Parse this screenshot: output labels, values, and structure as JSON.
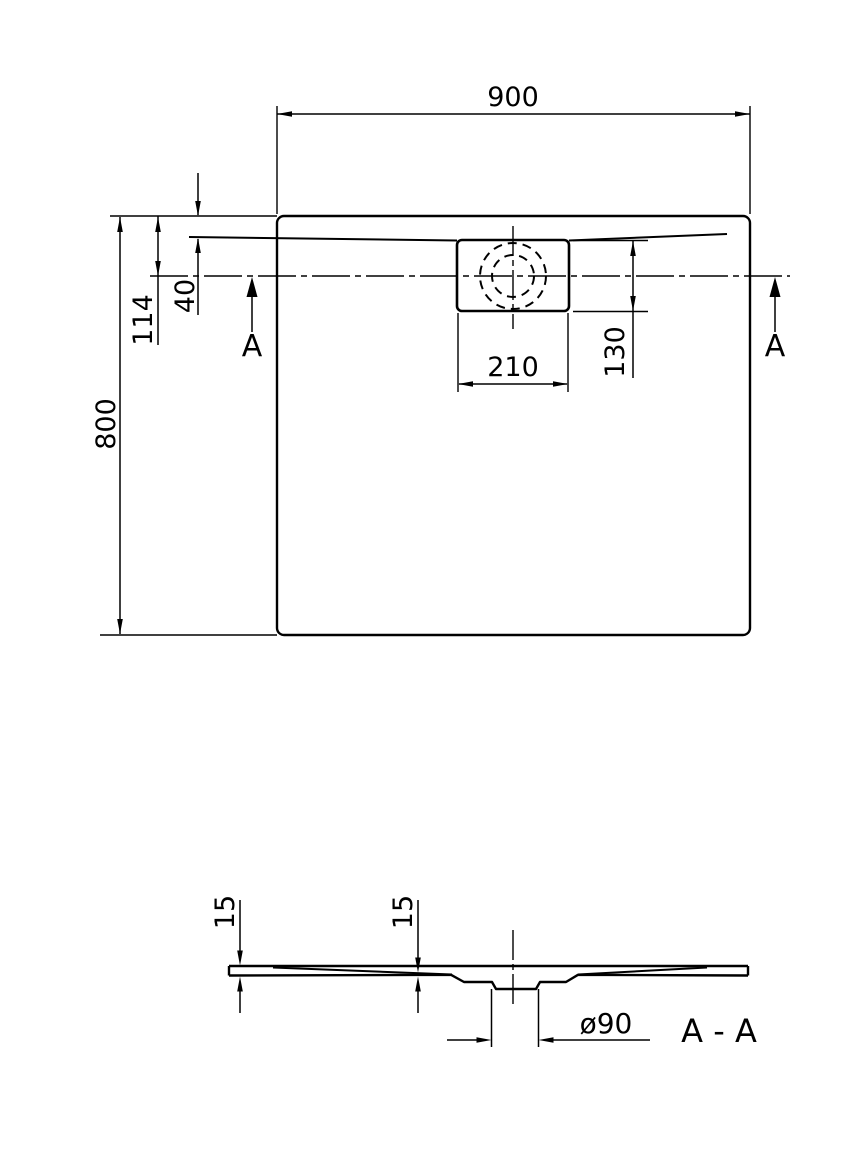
{
  "drawing": {
    "kind": "shower tray technical dimension drawing",
    "colors": {
      "line": "#000000",
      "background": "#ffffff"
    }
  },
  "top_view": {
    "width_label": "900",
    "height_label": "800",
    "edge_to_center_label": "114",
    "rim_offset_label": "40",
    "drain_width_label": "210",
    "drain_depth_label": "130",
    "section_marker_left": "A",
    "section_marker_right": "A"
  },
  "section_view": {
    "title": "A - A",
    "edge_height_label": "15",
    "drain_area_height_label": "15",
    "drain_diameter_label": "ø90"
  }
}
